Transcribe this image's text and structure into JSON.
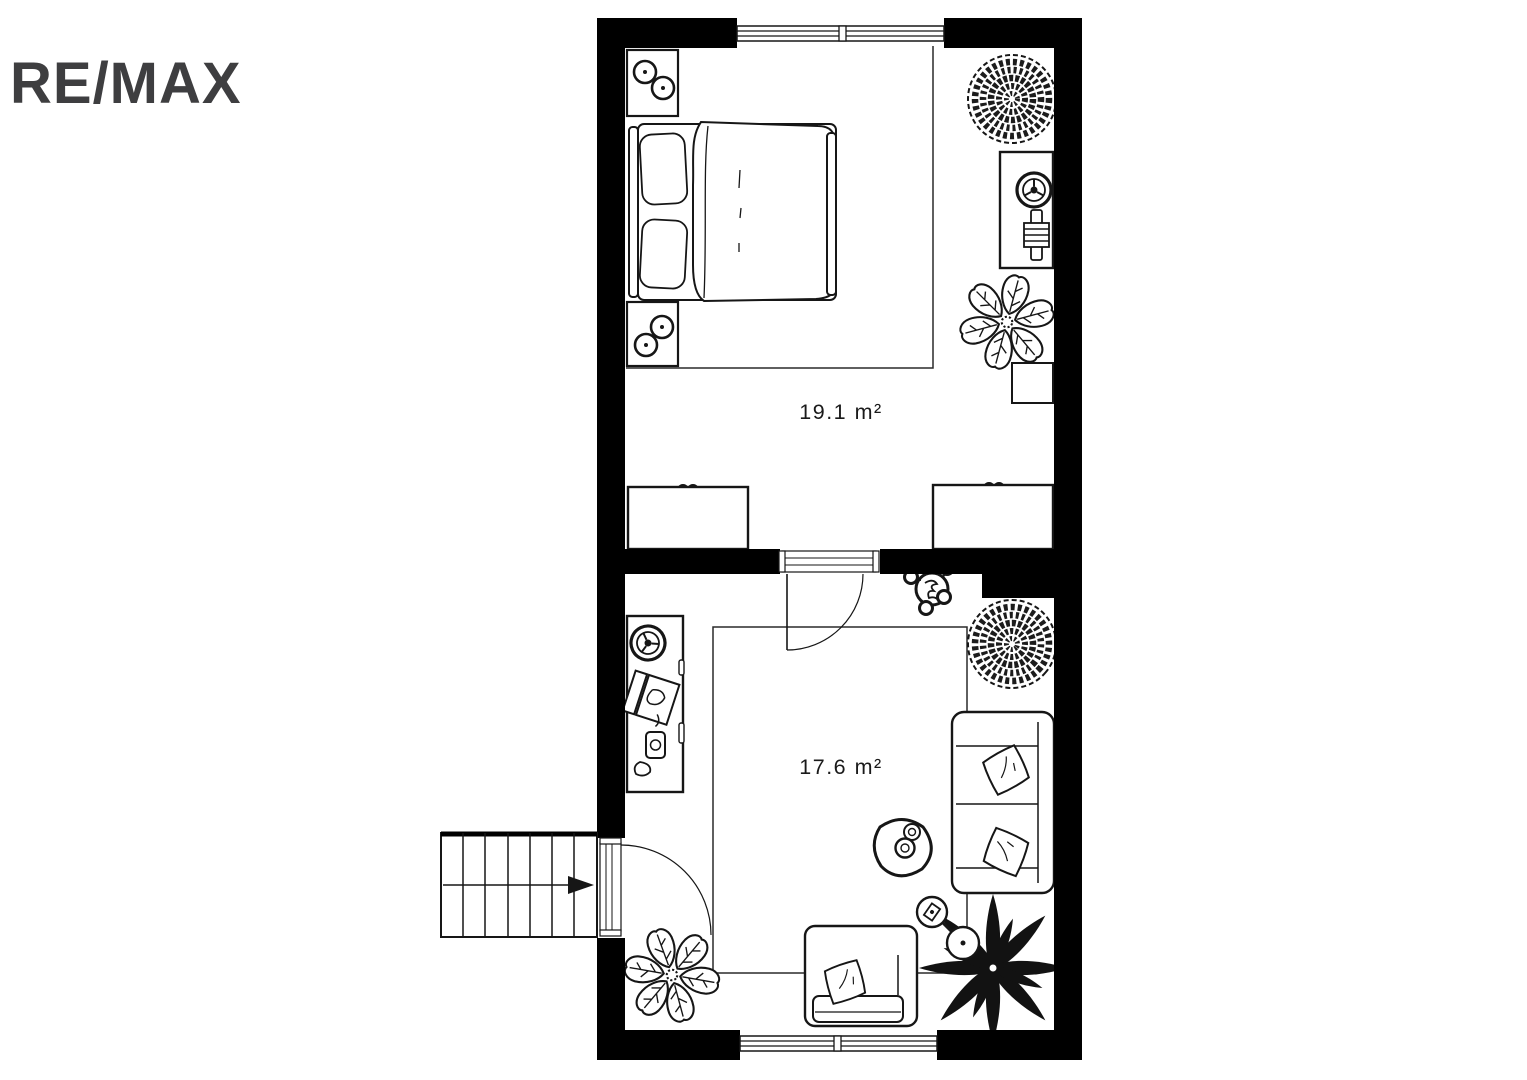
{
  "brand": {
    "logo_text": "RE/MAX",
    "logo_color": "#3E3E40"
  },
  "floor_plan": {
    "background": "#ffffff",
    "wall_color": "#000000",
    "line_color": "#1a1a1a",
    "rooms": [
      {
        "id": "bedroom",
        "area_label": "19.1 m²",
        "furniture": [
          "double-bed",
          "pillow",
          "pillow",
          "nightstand-with-lamp",
          "nightstand-with-lamp",
          "rug",
          "desk",
          "office-chair",
          "desk-equipment",
          "round-plant",
          "monstera-plant",
          "side-stool",
          "wardrobe",
          "wardrobe"
        ],
        "openings": [
          "window-top",
          "door-to-living-room"
        ]
      },
      {
        "id": "living-room",
        "area_label": "17.6 m²",
        "furniture": [
          "desk",
          "office-chair",
          "laptop",
          "telephone",
          "coat-stand",
          "round-plant",
          "carpet",
          "sofa",
          "cushion",
          "cushion",
          "armchair",
          "cushion",
          "side-table",
          "cups",
          "floor-lamp",
          "palm-plant",
          "monstera-plant"
        ],
        "openings": [
          "door-to-bedroom",
          "entry-door",
          "window-bottom"
        ]
      }
    ],
    "stairs": {
      "steps": 7,
      "direction_arrow": "right"
    }
  }
}
